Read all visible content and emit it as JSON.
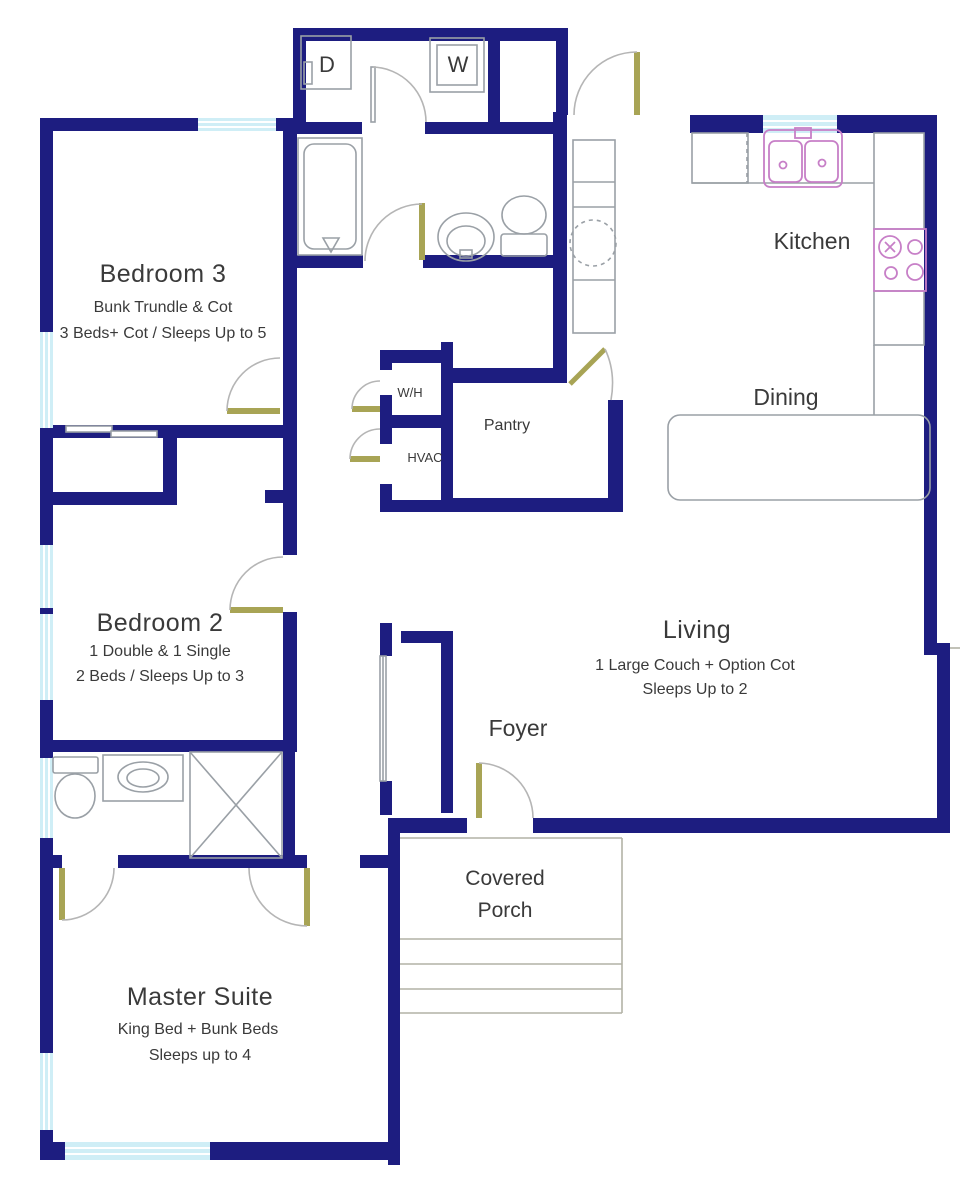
{
  "plan": {
    "rooms": {
      "bedroom3": {
        "name": "Bedroom 3",
        "line1": "Bunk Trundle & Cot",
        "line2": "3 Beds+ Cot / Sleeps Up to 5"
      },
      "bedroom2": {
        "name": "Bedroom 2",
        "line1": "1 Double & 1 Single",
        "line2": "2 Beds / Sleeps Up to 3"
      },
      "master": {
        "name": "Master Suite",
        "line1": "King Bed  + Bunk Beds",
        "line2": "Sleeps up to 4"
      },
      "living": {
        "name": "Living",
        "line1": "1 Large Couch + Option Cot",
        "line2": "Sleeps Up to 2"
      },
      "kitchen": {
        "name": "Kitchen"
      },
      "dining": {
        "name": "Dining"
      },
      "foyer": {
        "name": "Foyer"
      },
      "porch": {
        "line1": "Covered",
        "line2": "Porch"
      },
      "pantry": {
        "name": "Pantry"
      },
      "water_heater": {
        "name": "W/H"
      },
      "hvac": {
        "name": "HVAC"
      }
    },
    "appliances": {
      "dryer": "D",
      "washer": "W"
    },
    "colors": {
      "wall": "#1d1d80",
      "window": "#cfeef6",
      "door": "#a8a455",
      "fixture": "#9aa0a6",
      "kitchen_fixture": "#c77fc7",
      "text": "#3a3a3a"
    }
  }
}
